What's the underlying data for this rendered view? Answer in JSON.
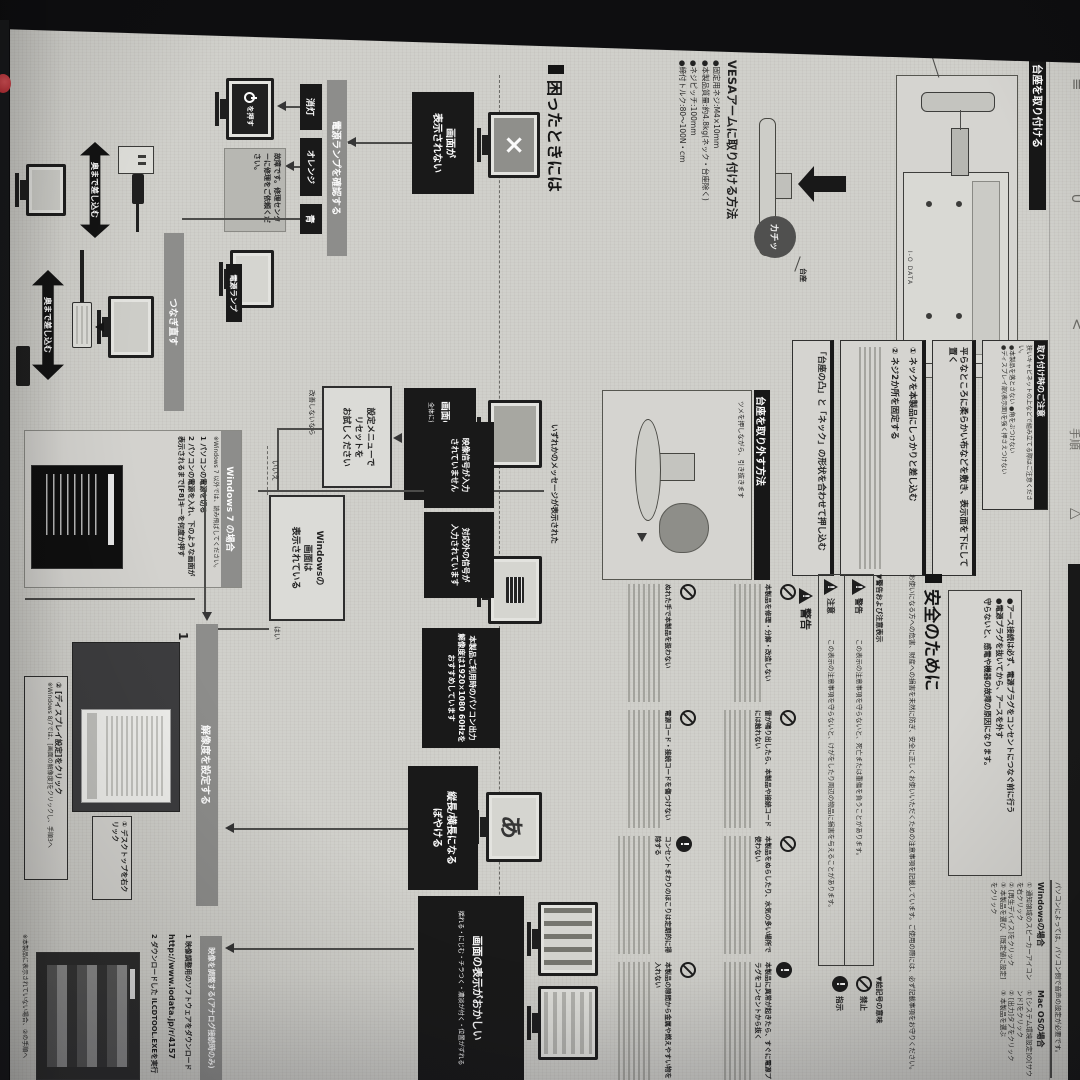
{
  "brand": {
    "logo": "I-O DATA"
  },
  "edge_glyphs": [
    "≡",
    "∪",
    "<",
    "手順",
    "△"
  ],
  "stand": {
    "header": "台座を取り付ける",
    "neck": "ネック",
    "caution_title": "取り付け時のご注意",
    "caution_intro": "狭いキャビネットの上などで組み立てる際はご注意ください。",
    "caution_bullets": "●本製品を落とさない ●角をぶつけない\n●ディスプレイ部(表示面)を強く押さえつけない",
    "step1": "平らなところに柔らかい布などを敷き、表示面を下にして置く",
    "step2": "① ネックを本製品にしっかりと差し込む",
    "step3": "② ネジ2か所を固定する",
    "step4": "「台座の凸」と「ネック」の形状を合わせて押し込む"
  },
  "vesa": {
    "header": "VESAアームに取り付ける方法",
    "specs": "●固定用ネジ:M4×10mm\n●本製品質量:約4.8kg(ネック・台座除く)\n●ネジピッチ:100mm\n●締付トルク:80〜100N・cm",
    "kachi": "カチッ",
    "daiza": "台座"
  },
  "remove": {
    "header": "台座を取り外す方法",
    "note": "ツメを押しながら、引き抜きます"
  },
  "audio": {
    "note": "パソコンによっては、パソコン側で音声の設定が必要です。",
    "win_title": "Windowsの場合",
    "win_steps": "① 通知領域のスピーカーアイコンを右クリック\n② [再生デバイス]をクリック\n③ 本製品を選び、[既定値に設定]をクリック",
    "mac_title": "Mac OSの場合",
    "mac_steps": "① [システム環境設定]の[サウンド]をクリック\n② [出力]タブをクリック\n③ 本製品を選ぶ"
  },
  "earth": "●アース接続は必ず、電源プラグをコンセントにつなぐ前に行う\n●電源プラグを抜いてから、アースを外す\n守らないと、感電や機器の故障の原因になります。",
  "safety": {
    "header": "安全のために",
    "intro": "お使いになる方への危害、財産への損害を未然に防ぎ、安全に正しくお使いいただくための注意事項を記載しています。ご使用の際には、必ず記載事項をお守りください。",
    "legend_title": "▼警告および注意表示",
    "warn_word": "警告",
    "warn_desc": "この表示の注意事項を守らないと、死亡または重傷を負うことがあります。",
    "caution_word": "注意",
    "caution_desc": "この表示の注意事項を守らないと、けがをしたり周辺の物品に損害を与えることがあります。",
    "symbols_title": "▼絵記号の意味",
    "sym1": "禁止",
    "sym2": "指示",
    "items": [
      {
        "t": "本製品を修理・分解・改造しない"
      },
      {
        "t": "雷が鳴り出したら、本製品や接続コードには触れない"
      },
      {
        "t": "本製品をぬらしたり、水気の多い場所で使わない"
      },
      {
        "t": "本製品に異常が起きたら、すぐに電源プラグをコンセントから抜く"
      },
      {
        "t": "ぬれた手で本製品を扱わない"
      },
      {
        "t": "電源コード・接続コードを傷つけない"
      },
      {
        "t": "コンセントまわりのほこりは定期的に掃除する"
      },
      {
        "t": "本製品の隙間から金属や燃えやすい物を入れない"
      }
    ]
  },
  "trouble": {
    "header": "困ったときには",
    "start": "画面が\n表示されない",
    "lamp_bar": "電源ランプを確認する",
    "off": "消灯",
    "orange": "オレンジ",
    "blue": "青",
    "press": "を押す",
    "fail": "故障です。修理センターに修理をご依頼ください。",
    "lamp": "電源ランプ",
    "reconnect": "つなぎ直す",
    "push": "奥まで差し込む",
    "color_title": "画面の色がおかしい",
    "color_sub": "全体に黄色や青がかかっている",
    "reset": "設定メニューで\nリセットを\nお試しください",
    "no_improve": "改善しないなら",
    "msg_label": "いずれかのメッセージが表示された",
    "msg1": "映像信号が入力\nされていません",
    "msg2": "対応外の信号が\n入力されています",
    "recommend": "本製品ご利用時のパソコン出力解像度は1920×1080 60Hzをおすすめしています",
    "win_q": "Windowsの\n画面は\n表示されている",
    "yes": "はい",
    "no": "いいえ",
    "win7_title": "Windows 7 の場合",
    "win7_note": "※Windows 7 以外では、読み飛ばしてください。",
    "win7_s1": "1 パソコンの電源を切る",
    "win7_s2": "2 パソコンの電源を入れ、下のような画面が表示されるまで[F8]キーを何度か押す",
    "res_bar": "解像度を設定する",
    "step_no": "1",
    "callout1": "① デスクトップを右クリック",
    "callout2": "② [ディスプレイ設定]をクリック",
    "callout2_note": "※Windows 8/7では、[画面の解像度]をクリックし、手順3へ",
    "aspect": "縦長/横長になる\nぼやける",
    "aspect_glyph": "あ",
    "disp_title": "画面の表示がおかしい",
    "disp_sub": "揺れる・にじむ・チラつく・濃淡が付く・位置がずれる",
    "adjust_bar": "映像を調整する(アナログ接続時のみ)",
    "adj_s1": "1 映像調整用のソフトウェアをダウンロード",
    "adj_url": "http://www.iodata.jp/r/4157",
    "adj_s2": "2 ダウンロードした ILCDTOOL.EXEを実行",
    "adj_note": "※本製品に表示されていない場合、②の手順へ"
  }
}
